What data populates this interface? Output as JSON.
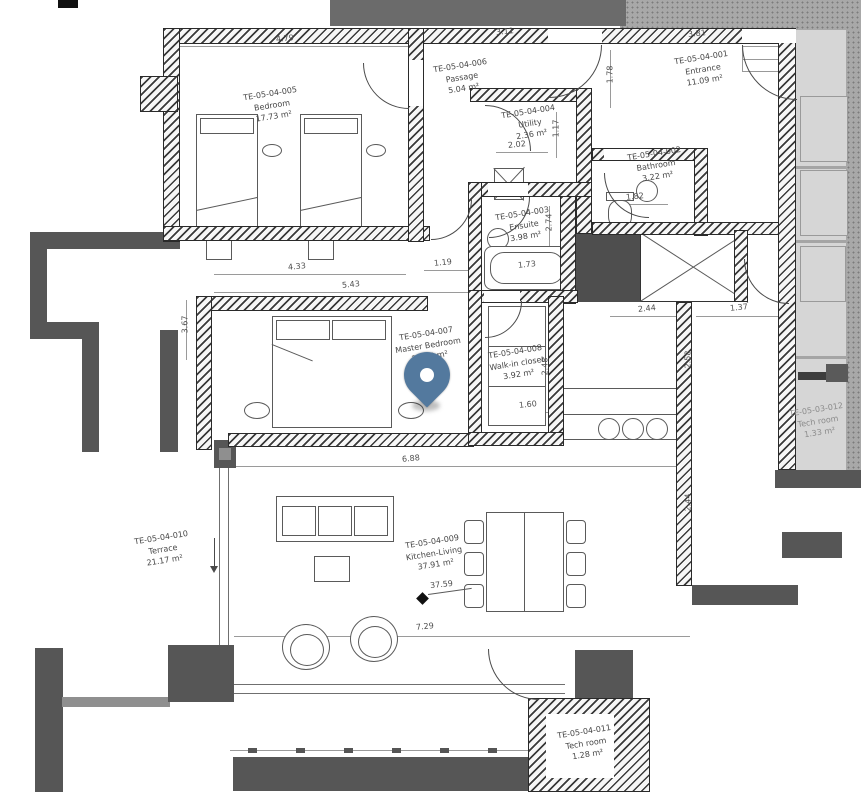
{
  "pin": {
    "color": "#53799e"
  },
  "rooms": [
    {
      "id": "TE-05-04-005",
      "name": "Bedroom",
      "area": "17.73 m²"
    },
    {
      "id": "TE-05-04-006",
      "name": "Passage",
      "area": "5.04 m²"
    },
    {
      "id": "TE-05-04-004",
      "name": "Utility",
      "area": "2.36 m²"
    },
    {
      "id": "TE-05-04-001",
      "name": "Entrance",
      "area": "11.09 m²"
    },
    {
      "id": "TE-05-04-002",
      "name": "Bathroom",
      "area": "3.22 m²"
    },
    {
      "id": "TE-05-04-003",
      "name": "Ensuite",
      "area": "3.98 m²"
    },
    {
      "id": "TE-05-04-007",
      "name": "Master Bedroom",
      "area": "20.98 m²"
    },
    {
      "id": "TE-05-04-008",
      "name": "Walk-in closet",
      "area": "3.92 m²"
    },
    {
      "id": "TE-05-04-010",
      "name": "Terrace",
      "area": "21.17 m²"
    },
    {
      "id": "TE-05-04-009",
      "name": "Kitchen-Living",
      "area": "37.91 m²"
    },
    {
      "id": "TE-05-04-011",
      "name": "Tech room",
      "area": "1.28 m²"
    },
    {
      "id": "TE-05-03-012",
      "name": "Tech room",
      "area": "1.33 m²"
    }
  ],
  "dimensions": {
    "bedroom_width": "4.79",
    "passage_width": "3.11",
    "entrance_width": "3.81",
    "entrance_depth": "1.78",
    "utility_width": "2.02",
    "utility_depth": "1.17",
    "bathroom_width": "1.82",
    "ensuite_depth": "2.74",
    "tub_width": "1.73",
    "corridor_width": "1.19",
    "master_width_a": "4.33",
    "master_width_b": "5.43",
    "master_depth": "3.67",
    "stair_width": "2.44",
    "stair_side": "1.37",
    "kitchen_depth": "2.58",
    "walkin_depth": "2.48",
    "walkin_width": "1.60",
    "living_width": "6.88",
    "living_width_b": "7.29",
    "living_depth": "2.44",
    "floor_level": "37.59"
  }
}
